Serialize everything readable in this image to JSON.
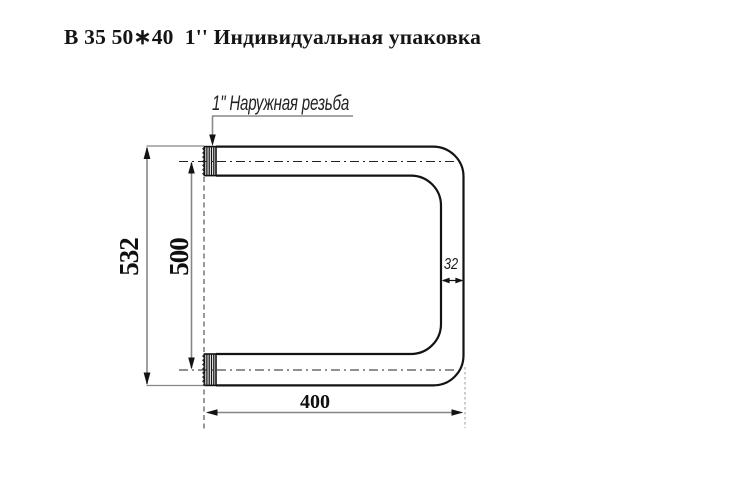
{
  "title": "В 35 50∗40  1'' Индивидуальная упаковка",
  "drawing": {
    "thread_label": "1\" Наружная резьба",
    "dim_overall_height": "532",
    "dim_center_distance": "500",
    "dim_width": "400",
    "dim_pipe_diameter": "32"
  },
  "colors": {
    "background": "#ffffff",
    "outline": "#131313",
    "dimension_line": "#868686",
    "centerline": "#222222",
    "text": "#151515"
  }
}
